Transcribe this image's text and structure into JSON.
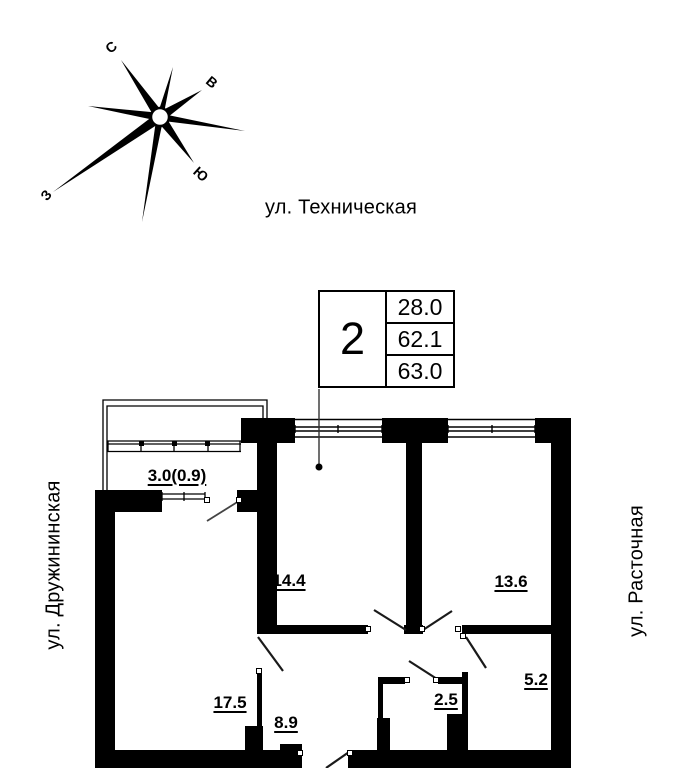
{
  "compass": {
    "north": "С",
    "east": "В",
    "south": "Ю",
    "west": "З"
  },
  "streets": {
    "top": "ул. Техническая",
    "left": "ул. Дружининская",
    "right": "ул. Расточная"
  },
  "info_box": {
    "rooms_count": "2",
    "values": [
      "28.0",
      "62.1",
      "63.0"
    ]
  },
  "room_areas": {
    "balcony": "3.0(0.9)",
    "room_left": "14.4",
    "room_right": "13.6",
    "living_room": "17.5",
    "hallway": "8.9",
    "bathroom": "2.5",
    "kitchen_niche": "5.2"
  },
  "colors": {
    "ink": "#000000",
    "paper": "#ffffff"
  }
}
